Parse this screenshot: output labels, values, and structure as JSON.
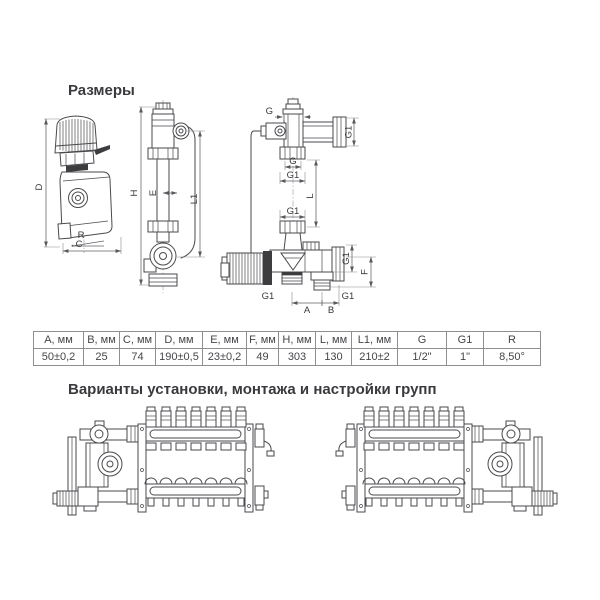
{
  "sections": {
    "dimensions_title": "Размеры",
    "variants_title": "Варианты установки, монтажа и настройки групп"
  },
  "dimension_labels": {
    "D": "D",
    "R": "R",
    "C": "C",
    "H": "H",
    "E": "E",
    "L1": "L1",
    "L": "L",
    "F": "F",
    "A": "A",
    "B": "B",
    "G": "G",
    "G1": "G1"
  },
  "table": {
    "headers": [
      "A, мм",
      "B, мм",
      "C, мм",
      "D, мм",
      "E, мм",
      "F, мм",
      "H, мм",
      "L, мм",
      "L1, мм",
      "G",
      "G1",
      "R"
    ],
    "values": [
      "50±0,2",
      "25",
      "74",
      "190±0,5",
      "23±0,2",
      "49",
      "303",
      "130",
      "210±2",
      "1/2\"",
      "1\"",
      "8,50°"
    ]
  }
}
